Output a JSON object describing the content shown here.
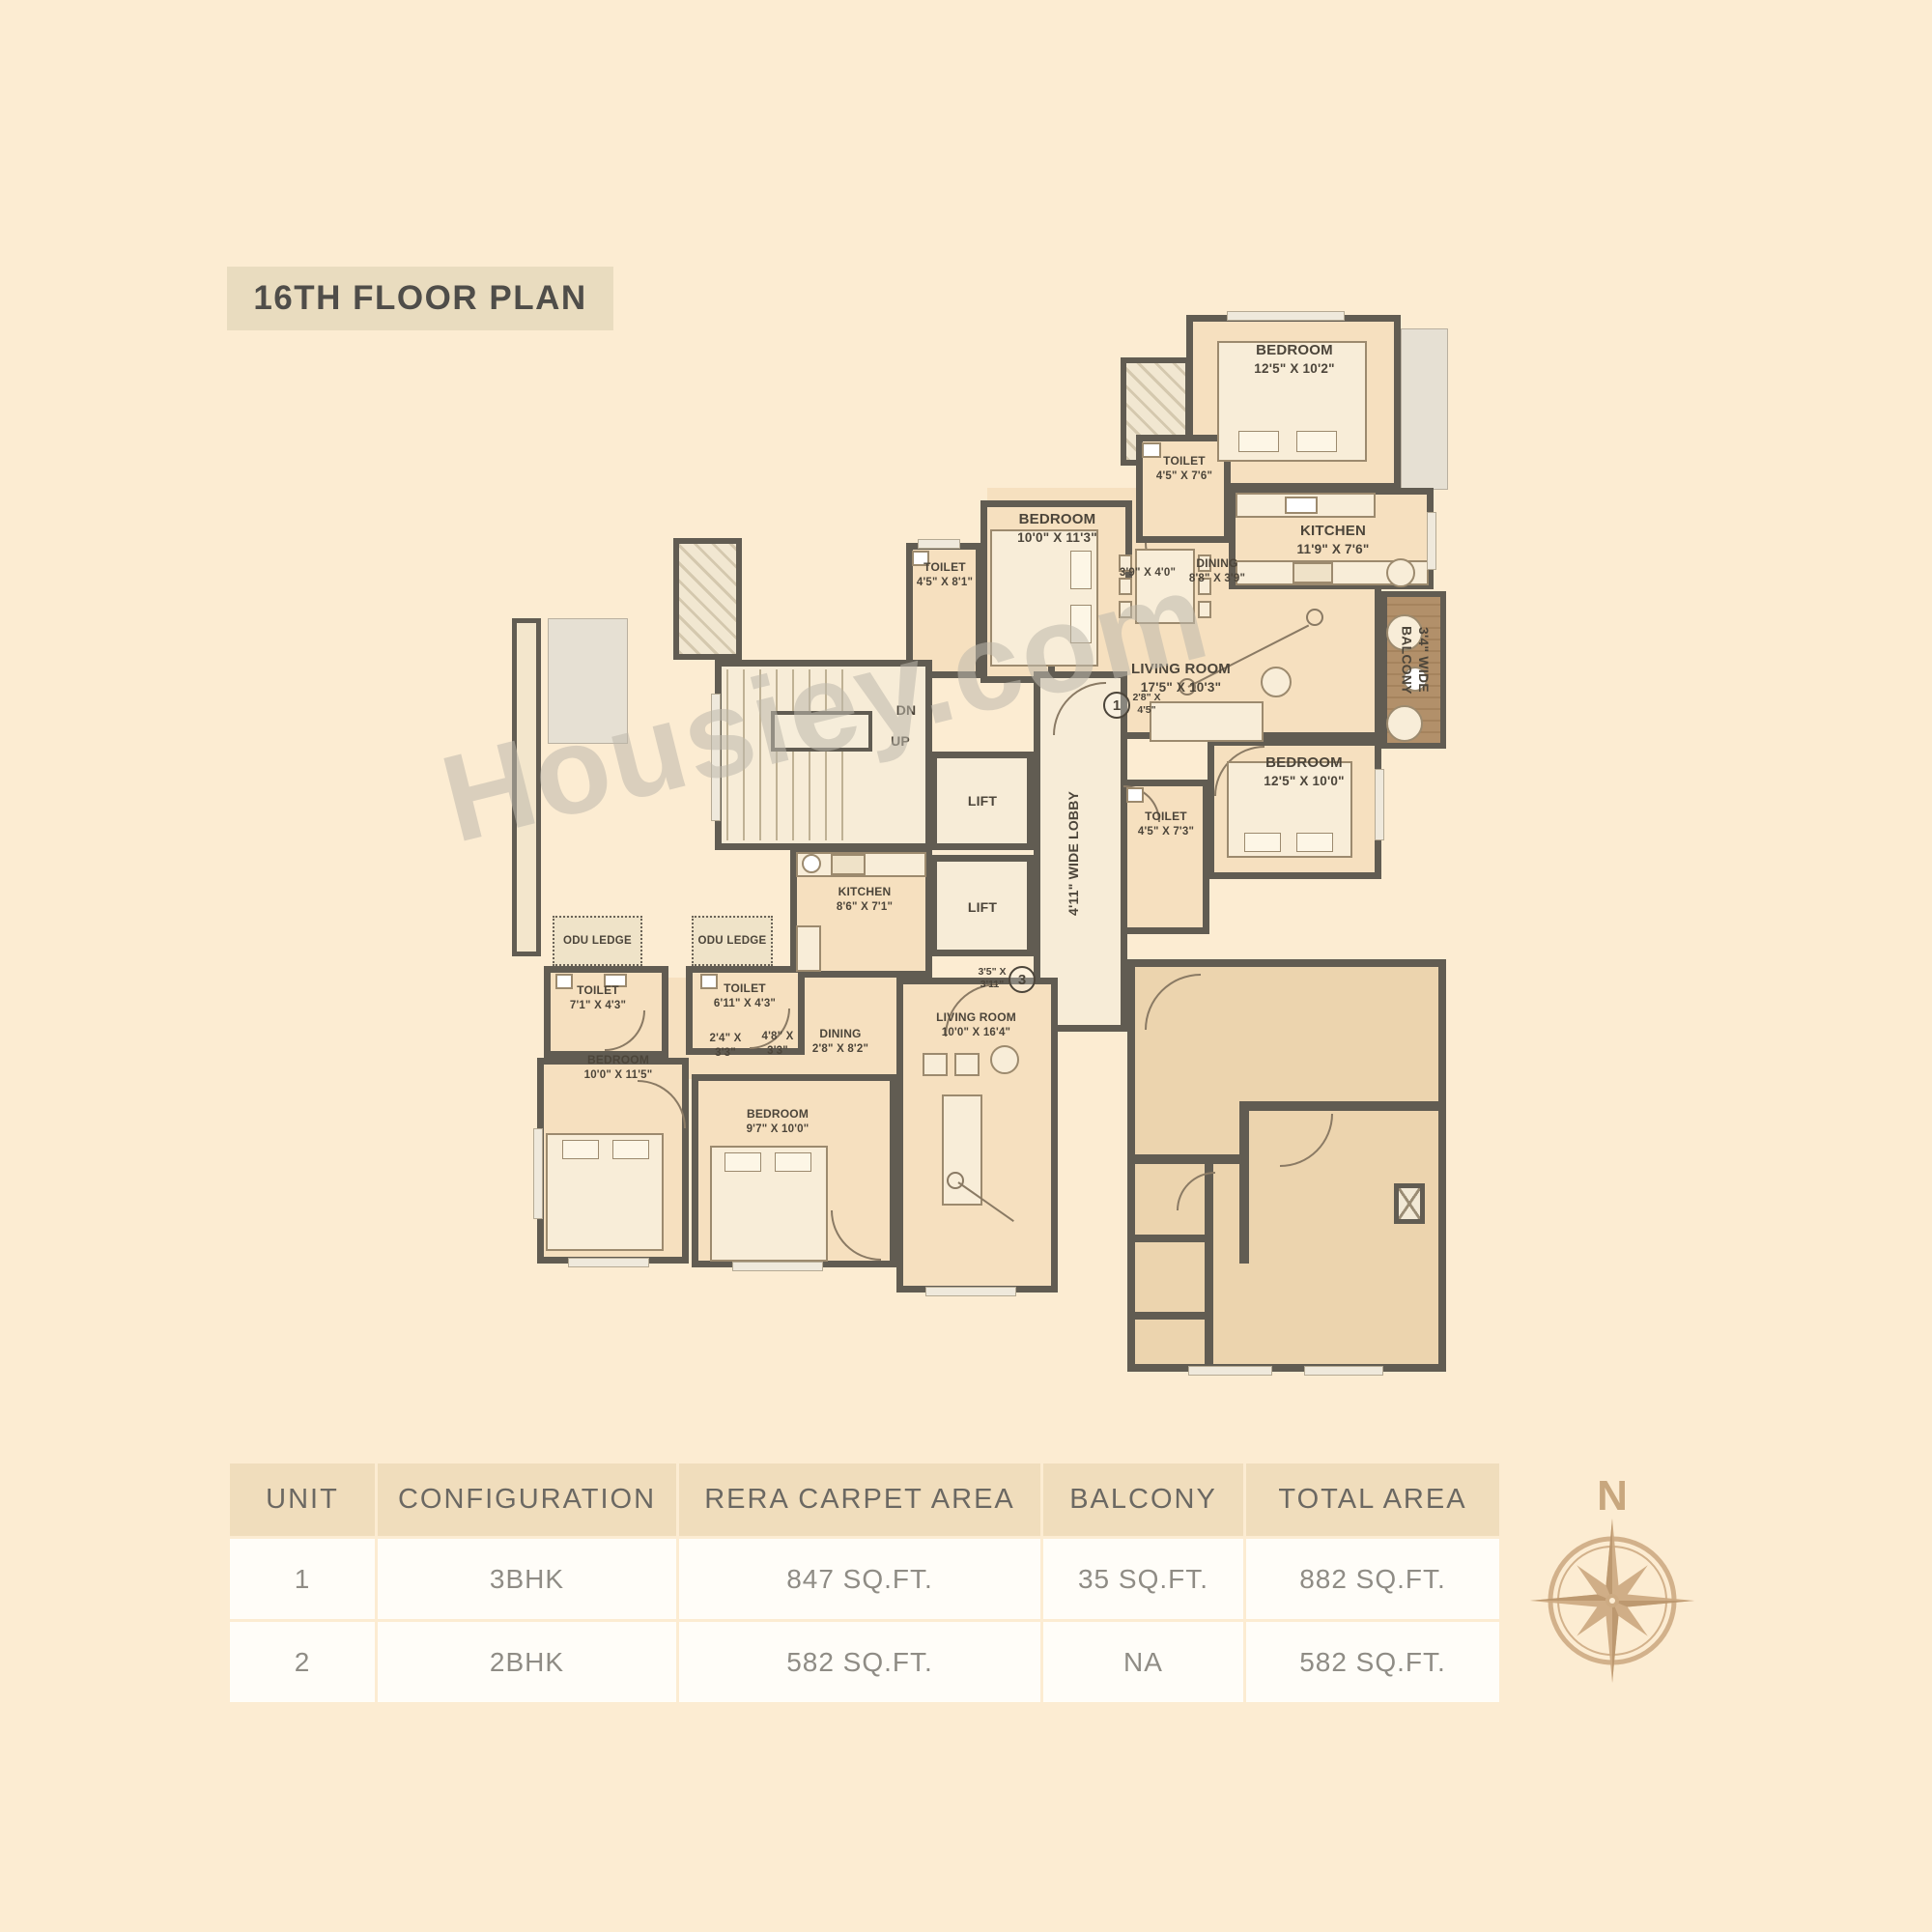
{
  "title": "16TH FLOOR PLAN",
  "watermark": "Housiey.com",
  "colors": {
    "background": "#fcecd2",
    "wall": "#615c52",
    "room_fill": "#f6e0bf",
    "greyed_unit_fill": "#ecd4ae",
    "balcony_deck": "#ad8a60",
    "table_header_bg": "#f0ddbc",
    "compass": "#cdab83"
  },
  "plan": {
    "unit1": {
      "marker": "1",
      "marker_dim": "2'8\" X 4'5\"",
      "bedroom1": {
        "name": "BEDROOM",
        "dim": "12'5\" X 10'2\""
      },
      "toilet1": {
        "name": "TOILET",
        "dim": "4'5\" X 7'6\""
      },
      "passage": "3'9\" X 4'0\"",
      "kitchen": {
        "name": "KITCHEN",
        "dim": "11'9\" X 7'6\""
      },
      "dining": {
        "name": "DINING",
        "dim": "8'8\" X 3'9\""
      },
      "bedroom2": {
        "name": "BEDROOM",
        "dim": "10'0\" X 11'3\""
      },
      "toilet2": {
        "name": "TOILET",
        "dim": "4'5\" X 8'1\""
      },
      "living": {
        "name": "LIVING ROOM",
        "dim": "17'5\" X 10'3\""
      },
      "balcony": "3'4\" WIDE BALCONY",
      "bedroom3": {
        "name": "BEDROOM",
        "dim": "12'5\" X 10'0\""
      },
      "toilet3": {
        "name": "TOILET",
        "dim": "4'5\" X 7'3\""
      }
    },
    "core": {
      "stair_dn": "DN",
      "stair_up": "UP",
      "lift": "LIFT",
      "lobby": "4'11\" WIDE LOBBY"
    },
    "unit2": {
      "marker": "3",
      "marker_dim": "3'5\" X 3'11\"",
      "kitchen": {
        "name": "KITCHEN",
        "dim": "8'6\" X 7'1\""
      },
      "odu_ledge": "ODU LEDGE",
      "toilet1": {
        "name": "TOILET",
        "dim": "7'1\" X 4'3\""
      },
      "toilet2": {
        "name": "TOILET",
        "dim": "6'11\" X 4'3\""
      },
      "bedroom1": {
        "name": "BEDROOM",
        "dim": "10'0\" X 11'5\""
      },
      "bedroom2": {
        "name": "BEDROOM",
        "dim": "9'7\" X 10'0\""
      },
      "dining": {
        "name": "DINING",
        "dim": "2'8\" X 8'2\""
      },
      "passage1": "2'4\" X 3'3\"",
      "passage2": "4'8\" X 3'3\"",
      "living": {
        "name": "LIVING ROOM",
        "dim": "10'0\" X 16'4\""
      }
    }
  },
  "compass": {
    "label": "N"
  },
  "table": {
    "headers": [
      "UNIT",
      "CONFIGURATION",
      "RERA CARPET AREA",
      "BALCONY",
      "TOTAL AREA"
    ],
    "rows": [
      {
        "unit": "1",
        "configuration": "3BHK",
        "rera_carpet_area": "847 SQ.FT.",
        "balcony": "35 SQ.FT.",
        "total_area": "882 SQ.FT."
      },
      {
        "unit": "2",
        "configuration": "2BHK",
        "rera_carpet_area": "582 SQ.FT.",
        "balcony": "NA",
        "total_area": "582 SQ.FT."
      }
    ]
  }
}
